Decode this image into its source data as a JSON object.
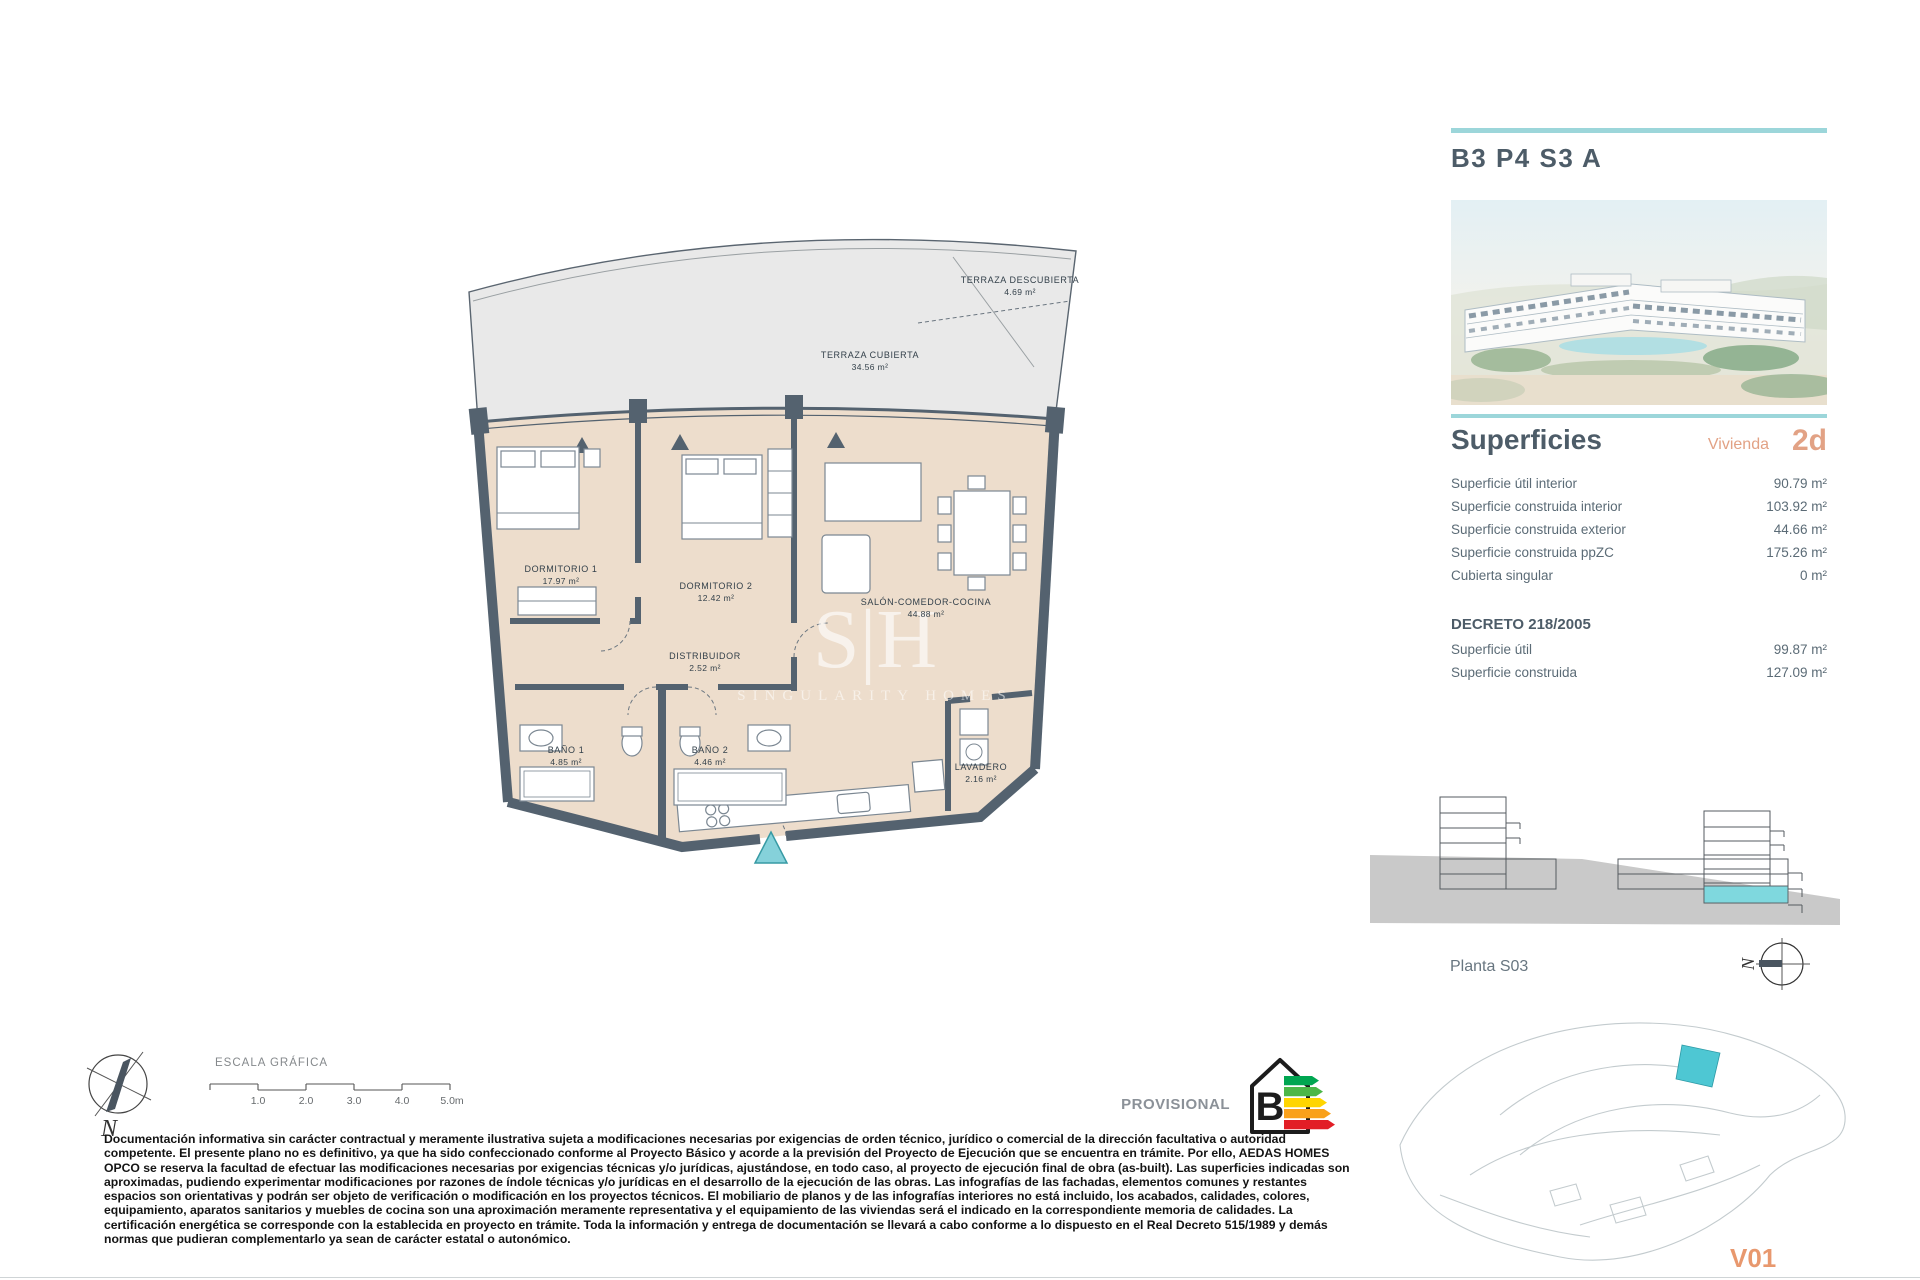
{
  "unit": {
    "code": "B3 P4 S3 A",
    "version": "V01"
  },
  "superficies": {
    "title": "Superficies",
    "vivienda_label": "Vivienda",
    "vivienda_type": "2d",
    "rows": [
      {
        "label": "Superficie útil interior",
        "value": "90.79 m²"
      },
      {
        "label": "Superficie construida interior",
        "value": "103.92 m²"
      },
      {
        "label": "Superficie construida exterior",
        "value": "44.66 m²"
      },
      {
        "label": "Superficie construida ppZC",
        "value": "175.26 m²"
      },
      {
        "label": "Cubierta singular",
        "value": "0 m²"
      }
    ]
  },
  "decreto": {
    "title": "DECRETO 218/2005",
    "rows": [
      {
        "label": "Superficie útil",
        "value": "99.87 m²"
      },
      {
        "label": "Superficie construida",
        "value": "127.09 m²"
      }
    ]
  },
  "plan": {
    "rooms": [
      {
        "name": "TERRAZA DESCUBIERTA",
        "area": "4.69 m²"
      },
      {
        "name": "TERRAZA CUBIERTA",
        "area": "34.56 m²"
      },
      {
        "name": "DORMITORIO 1",
        "area": "17.97 m²"
      },
      {
        "name": "DORMITORIO 2",
        "area": "12.42 m²"
      },
      {
        "name": "SALÓN-COMEDOR-COCINA",
        "area": "44.88 m²"
      },
      {
        "name": "DISTRIBUIDOR",
        "area": "2.52 m²"
      },
      {
        "name": "BAÑO 1",
        "area": "4.85 m²"
      },
      {
        "name": "BAÑO 2",
        "area": "4.46 m²"
      },
      {
        "name": "LAVADERO",
        "area": "2.16 m²"
      }
    ],
    "watermark": {
      "initials": "S|H",
      "name": "SINGULARITY HOMES"
    }
  },
  "floor_label": "Planta S03",
  "compass": {
    "north_label": "N"
  },
  "scale": {
    "title": "ESCALA GRÁFICA",
    "ticks": [
      "1.0",
      "2.0",
      "3.0",
      "4.0",
      "5.0m"
    ]
  },
  "energy": {
    "label": "PROVISIONAL",
    "rating": "B"
  },
  "disclaimer": "Documentación informativa sin carácter contractual y meramente ilustrativa sujeta a modificaciones necesarias por exigencias de orden técnico, jurídico o comercial de la dirección facultativa o autoridad competente. El presente plano no es definitivo, ya que ha sido confeccionado conforme al Proyecto Básico y acorde a la previsión del Proyecto de Ejecución que se encuentra en trámite. Por ello, AEDAS HOMES OPCO se reserva la facultad de efectuar las modificaciones necesarias por exigencias técnicas y/o jurídicas, ajustándose, en todo caso, al proyecto de ejecución final de obra (as-built). Las superficies indicadas son aproximadas, pudiendo experimentar modificaciones por razones de índole técnicas y/o jurídicas en el desarrollo de la ejecución de las obras. Las infografías de las fachadas, elementos comunes y restantes espacios son orientativas y podrán ser objeto de verificación o modificación en los proyectos técnicos. El mobiliario de planos y de las infografías interiores no está incluido, los acabados, calidades, colores, equipamiento, aparatos sanitarios y muebles de cocina son una aproximación meramente representativa y el equipamiento de las viviendas será el indicado en la correspondiente memoria de calidades. La certificación energética se corresponde con la establecida en proyecto en trámite. Toda la información y entrega de documentación se llevará a cabo conforme a lo dispuesto en el Real Decreto 515/1989 y demás normas que pudieran complementarlo ya sean de carácter estatal o autonómico.",
  "colors": {
    "accent_teal": "#9cd6da",
    "accent_salmon": "#e2a285",
    "wall": "#54626f",
    "interior_fill": "#edddcc",
    "terrace_fill": "#e9e9e9",
    "highlight_teal": "#7fd8de",
    "site_unit_teal": "#4ec7d3",
    "energy_bars": [
      "#00a651",
      "#4cb748",
      "#ffd500",
      "#f9a11b",
      "#f26522",
      "#e21e26"
    ]
  }
}
